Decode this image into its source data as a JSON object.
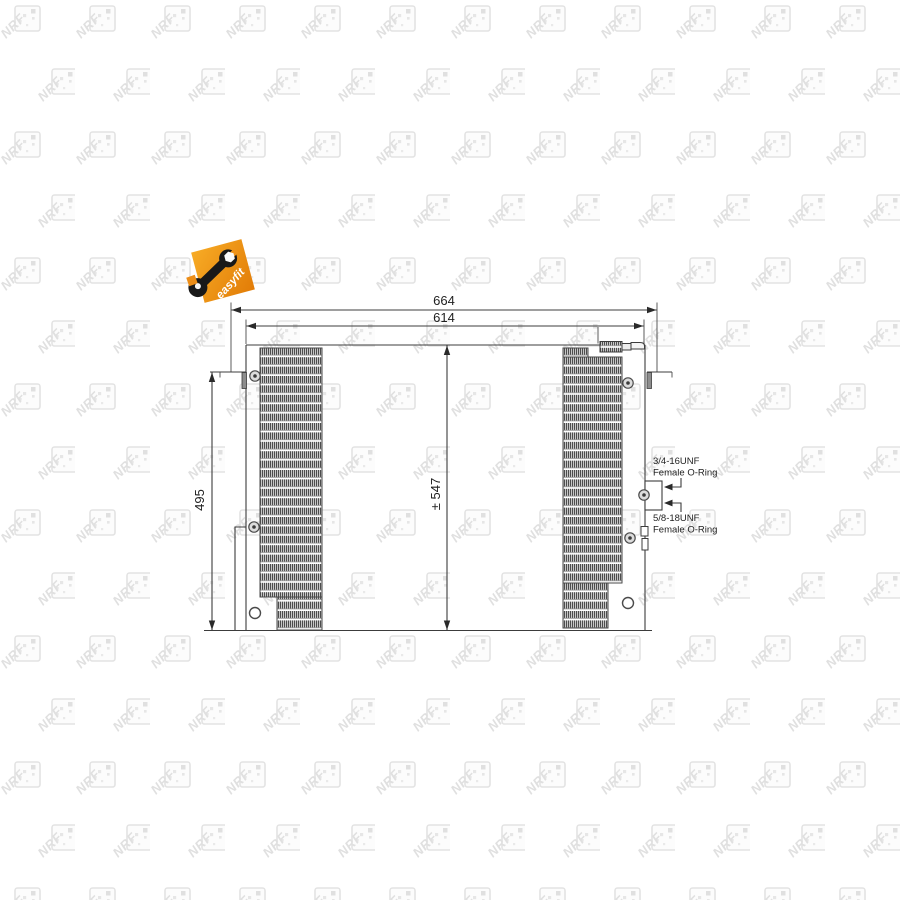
{
  "drawing": {
    "dimensions": {
      "overall_width": "664",
      "core_width": "614",
      "side_height": "495",
      "total_height": "± 547"
    },
    "connections": {
      "port_top_thread": "3/4-16UNF",
      "port_top_seal": "Female O-Ring",
      "port_bottom_thread": "5/8-18UNF",
      "port_bottom_seal": "Female O-Ring"
    },
    "branding": {
      "easyfit_label": "easyfit",
      "watermark_text": "NRF"
    },
    "colors": {
      "easyfit_orange": "#EF9318",
      "line": "#3C3C3C",
      "watermark_gray": "#E2E2E2",
      "fin_dark": "#4D4D4D"
    }
  }
}
